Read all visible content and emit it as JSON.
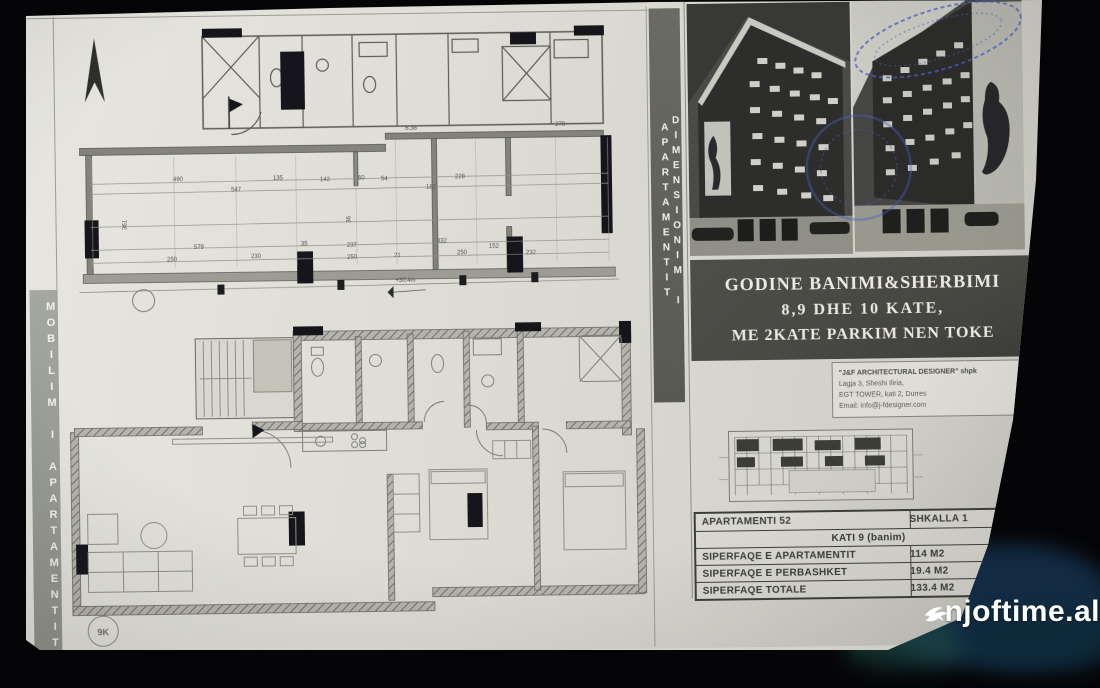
{
  "strips": {
    "left": "MOBILIM I APARTAMENTIT",
    "right": "DIMENSIONIM I APARTAMENTIT"
  },
  "title_block": {
    "line1": "GODINE BANIMI&SHERBIMI",
    "line2": "8,9 DHE 10 KATE,",
    "line3": "ME 2KATE PARKIM NEN TOKE"
  },
  "architect_box": {
    "line1": "\"J&F ARCHITECTURAL DESIGNER\" shpk",
    "line2": "Lagja 3, Sheshi Iliria,",
    "line3": "EGT TOWER, kati 2, Durres",
    "line4": "Email: info@j-fdesigner.com"
  },
  "info_table": {
    "rows": [
      {
        "label": "APARTAMENTI 52",
        "value": "SHKALLA 1"
      },
      {
        "label": "KATI 9 (banim)",
        "value": ""
      },
      {
        "label": "SIPERFAQE E APARTAMENTIT",
        "value": "114 M2"
      },
      {
        "label": "SIPERFAQE E PERBASHKET",
        "value": "19.4 M2"
      },
      {
        "label": "SIPERFAQE TOTALE",
        "value": "133.4 M2"
      }
    ]
  },
  "plan_top": {
    "level_marker": "+30.4m",
    "dims": [
      {
        "t": "490",
        "x": 117,
        "y": 160
      },
      {
        "t": "547",
        "x": 175,
        "y": 171
      },
      {
        "t": "135",
        "x": 217,
        "y": 160
      },
      {
        "t": "142",
        "x": 264,
        "y": 162
      },
      {
        "t": "60",
        "x": 302,
        "y": 161
      },
      {
        "t": "54",
        "x": 325,
        "y": 162
      },
      {
        "t": "182",
        "x": 370,
        "y": 171
      },
      {
        "t": "228",
        "x": 399,
        "y": 161
      },
      {
        "t": "6.36",
        "x": 350,
        "y": 112
      },
      {
        "t": "278",
        "x": 500,
        "y": 110
      },
      {
        "t": "579",
        "x": 137,
        "y": 228
      },
      {
        "t": "35",
        "x": 244,
        "y": 226
      },
      {
        "t": "237",
        "x": 290,
        "y": 228
      },
      {
        "t": "332",
        "x": 380,
        "y": 225
      },
      {
        "t": "250",
        "x": 110,
        "y": 240
      },
      {
        "t": "230",
        "x": 194,
        "y": 238
      },
      {
        "t": "250",
        "x": 290,
        "y": 240
      },
      {
        "t": "21",
        "x": 337,
        "y": 239
      },
      {
        "t": "250",
        "x": 400,
        "y": 237
      },
      {
        "t": "152",
        "x": 432,
        "y": 231
      },
      {
        "t": "232",
        "x": 469,
        "y": 238
      },
      {
        "t": "361",
        "x": 66,
        "y": 212,
        "r": -90
      },
      {
        "t": "36",
        "x": 290,
        "y": 208,
        "r": -90
      }
    ]
  },
  "plan_bottom": {
    "grid_marker": "9K"
  },
  "watermark": {
    "text": "njoftime.al",
    "icon": "swallow-bird-icon"
  },
  "colors": {
    "stamp_blue": "#4a5fc0",
    "paper": "#deddd6",
    "strip_gray": "#5f6058",
    "table_ink": "#3c3c36"
  }
}
